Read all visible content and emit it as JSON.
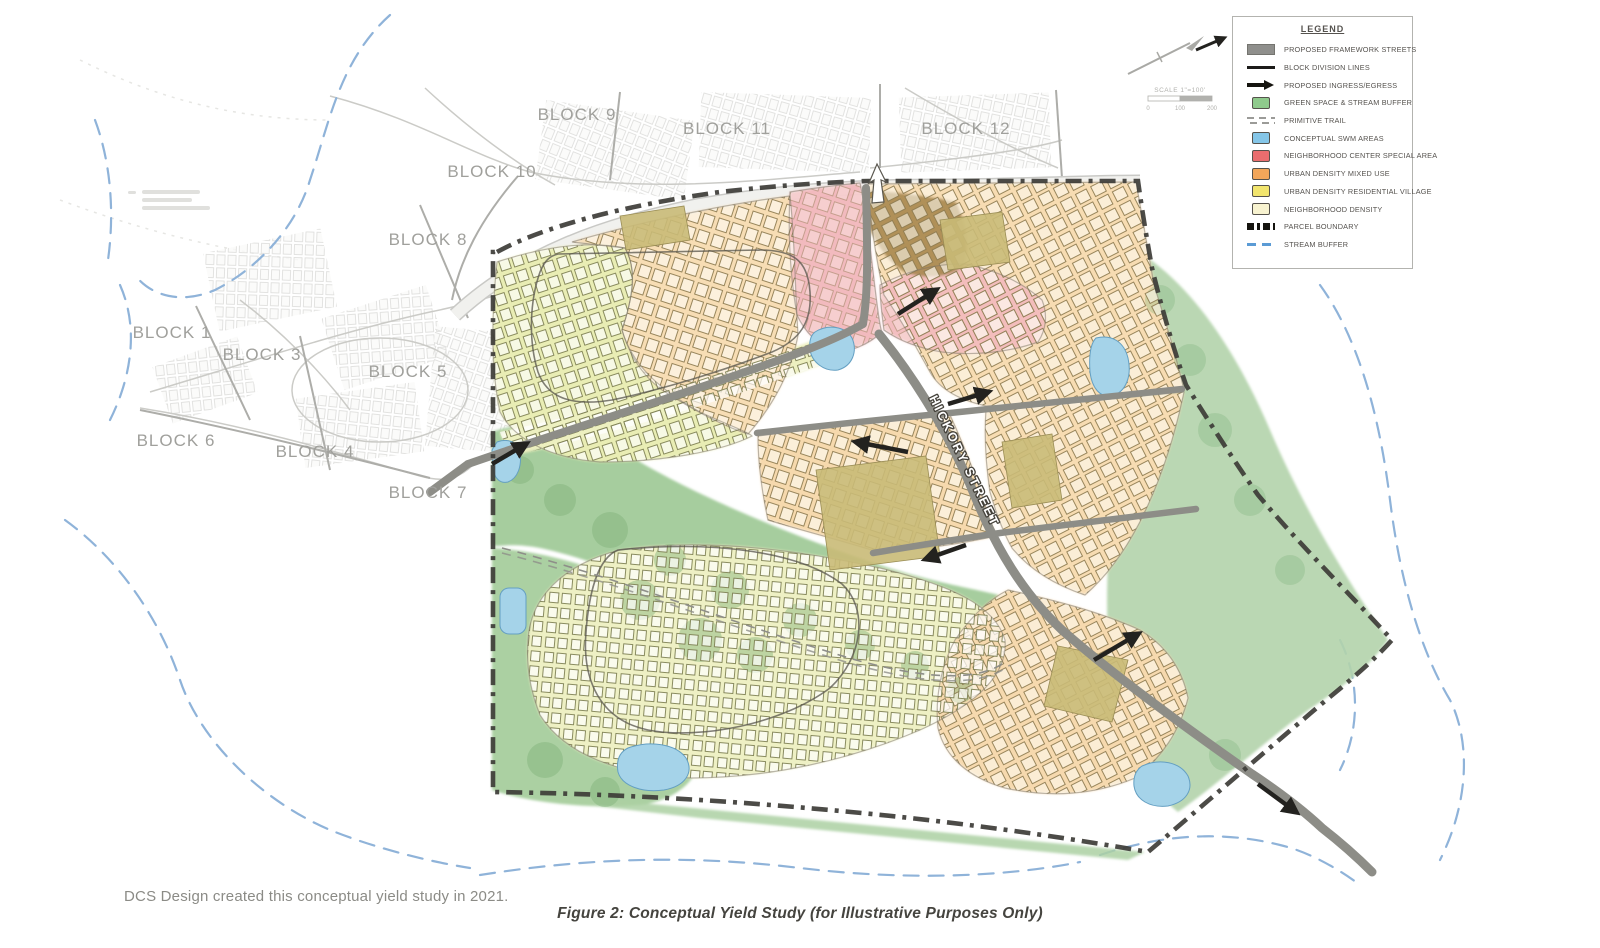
{
  "captions": {
    "credit": "DCS Design created this conceptual yield study in 2021.",
    "figure": "Figure 2:  Conceptual Yield Study (for Illustrative Purposes Only)"
  },
  "legend": {
    "title": "LEGEND",
    "items": [
      {
        "label": "PROPOSED FRAMEWORK STREETS",
        "swatch": "gray-rect",
        "color": "#8f8f8c"
      },
      {
        "label": "BLOCK DIVISION LINES",
        "swatch": "black-line",
        "color": "#1c1b19"
      },
      {
        "label": "PROPOSED INGRESS/EGRESS",
        "swatch": "black-arrow",
        "color": "#15140f"
      },
      {
        "label": "GREEN SPACE & STREAM BUFFER",
        "swatch": "square",
        "color": "#8fca8c"
      },
      {
        "label": "PRIMITIVE TRAIL",
        "swatch": "double-dash",
        "color": "#9b9b98"
      },
      {
        "label": "CONCEPTUAL SWM AREAS",
        "swatch": "square",
        "color": "#85c6e8"
      },
      {
        "label": "NEIGHBORHOOD CENTER SPECIAL AREA",
        "swatch": "square",
        "color": "#e96d6e"
      },
      {
        "label": "URBAN DENSITY MIXED USE",
        "swatch": "square",
        "color": "#f2a65a"
      },
      {
        "label": "URBAN DENSITY RESIDENTIAL VILLAGE",
        "swatch": "square",
        "color": "#f2e56e"
      },
      {
        "label": "NEIGHBORHOOD DENSITY",
        "swatch": "square",
        "color": "#f8f3d0"
      },
      {
        "label": "PARCEL BOUNDARY",
        "swatch": "bold-dash",
        "color": "#15140f"
      },
      {
        "label": "STREAM BUFFER",
        "swatch": "blue-dash",
        "color": "#5b9bd5"
      }
    ]
  },
  "scale_bar": {
    "label": "SCALE 1\"=100'",
    "ticks": [
      "0",
      "100",
      "200"
    ]
  },
  "map": {
    "street_label": "HICKORY STREET",
    "blocks": [
      {
        "label": "BLOCK 1"
      },
      {
        "label": "BLOCK 3"
      },
      {
        "label": "BLOCK 5"
      },
      {
        "label": "BLOCK 6"
      },
      {
        "label": "BLOCK 4"
      },
      {
        "label": "BLOCK 7"
      },
      {
        "label": "BLOCK 8"
      },
      {
        "label": "BLOCK 9"
      },
      {
        "label": "BLOCK 10"
      },
      {
        "label": "BLOCK 11"
      },
      {
        "label": "BLOCK 12"
      }
    ],
    "colors": {
      "green_space": "#a6cd9e",
      "swm_pond": "#a5d3e9",
      "neighborhood_center": "#f1b6ba",
      "mixed_use": "#f7ddb4",
      "residential_village": "#e9edb4",
      "framework_street": "#8d8d87",
      "parcel_boundary": "#3d3c37",
      "stream_buffer": "#8fb3d9"
    }
  }
}
